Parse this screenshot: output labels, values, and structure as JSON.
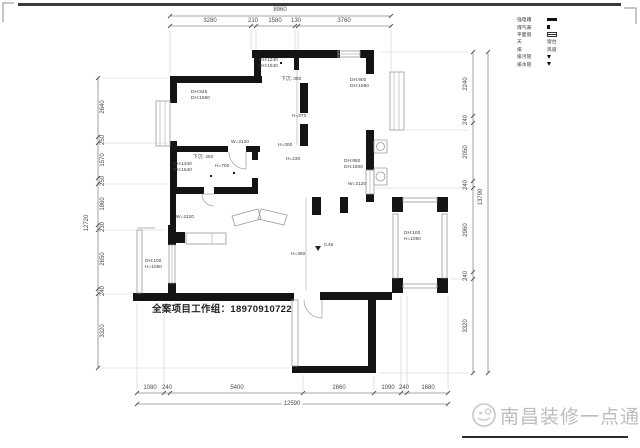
{
  "frame": {
    "contact": "全案项目工作组：18970910722",
    "watermark": "南昌装修一点通"
  },
  "legend": {
    "rows": [
      {
        "label": "强电箱",
        "symbol": "bar"
      },
      {
        "label": "煤气表",
        "symbol": "dot"
      },
      {
        "label": "平面窗",
        "symbol": "window"
      },
      {
        "label": "天",
        "value": "窗台"
      },
      {
        "label": "排",
        "value": "风道"
      },
      {
        "label": "排污管",
        "symbol": "triangle"
      },
      {
        "label": "排水管",
        "symbol": "triangle"
      }
    ]
  },
  "dims": {
    "top": {
      "total": "8960",
      "segments": [
        "3280",
        "210",
        "1580",
        "130",
        "3760"
      ]
    },
    "bottom": {
      "total": "12590",
      "segments": [
        "1080",
        "240",
        "5400",
        "2860",
        "1090",
        "240",
        "1680"
      ]
    },
    "left": {
      "total": "12720",
      "segments": [
        "2640",
        "250",
        "1570",
        "250",
        "1860",
        "230",
        "2650",
        "240",
        "3320"
      ]
    },
    "right": {
      "total": "13790",
      "segments": [
        "2240",
        "240",
        "2050",
        "240",
        "2960",
        "240",
        "3320"
      ]
    }
  },
  "plan": {
    "labels": [
      {
        "text": "DH:945\nDH:1560"
      },
      {
        "text": "DH:1240\nDH:1540"
      },
      {
        "text": "下沉: 300"
      },
      {
        "text": "DH:900\nDH:1560"
      },
      {
        "text": "下沉: 450"
      },
      {
        "text": "DH:1340\nDH:1540"
      },
      {
        "text": "H=700"
      },
      {
        "text": "W=2120"
      },
      {
        "text": "H=300"
      },
      {
        "text": "H=230"
      },
      {
        "text": "H=370"
      },
      {
        "text": "W=2120"
      },
      {
        "text": "DH:950\nDH:1500"
      },
      {
        "text": "DH:100\nH=1050"
      },
      {
        "text": "DH:100\nH=1060"
      },
      {
        "text": "H=360"
      },
      {
        "text": "W=2120"
      },
      {
        "text": "0.45"
      }
    ]
  }
}
